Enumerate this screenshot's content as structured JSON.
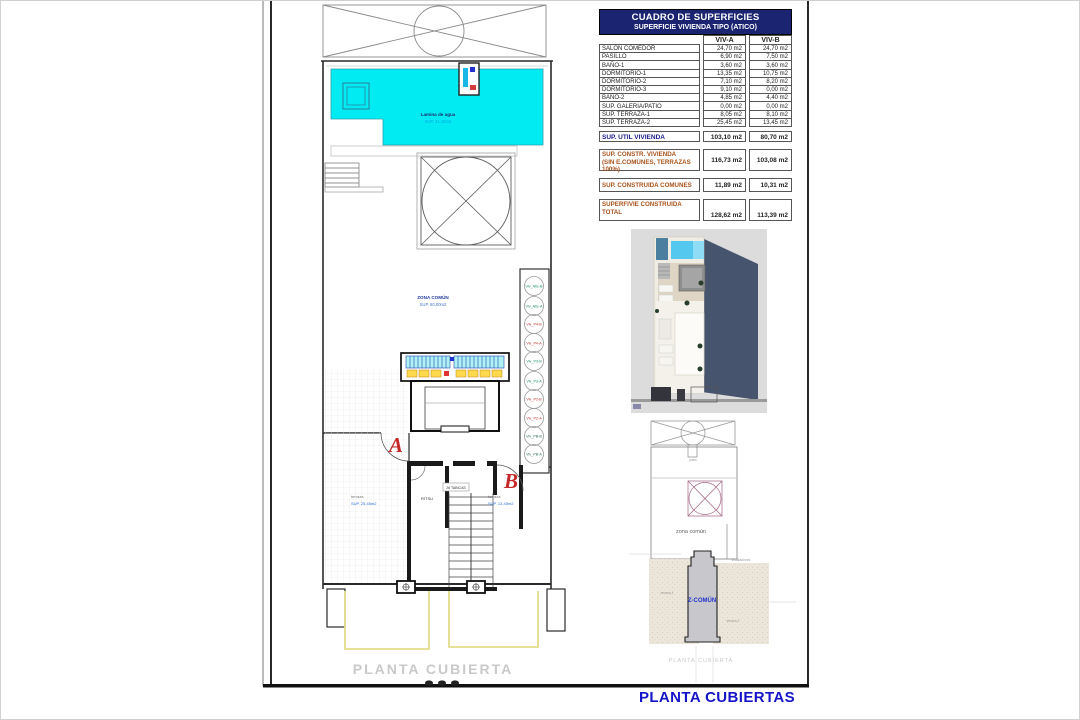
{
  "sheet": {
    "title": "PLANTA CUBIERTAS"
  },
  "colors": {
    "header_navy": "#1b2470",
    "total_navy": "#1a1a8c",
    "section_brown": "#a8521a",
    "sheet_blue": "#1414c8",
    "pool_cyan": "#00ecf2",
    "marker_red": "#c62828"
  },
  "surface_table": {
    "title": "CUADRO DE SUPERFICIES",
    "subtitle": "SUPERFICIE VIVIENDA TIPO  (ATICO)",
    "col_a": "VIV-A",
    "col_b": "VIV-B",
    "rows": [
      {
        "label": "SALON COMEDOR",
        "a": "24,70 m2",
        "b": "24,70 m2"
      },
      {
        "label": "PASILLO",
        "a": "6,90 m2",
        "b": "7,50 m2"
      },
      {
        "label": "BAÑO-1",
        "a": "3,60 m2",
        "b": "3,60 m2"
      },
      {
        "label": "DORMITORIO-1",
        "a": "13,35 m2",
        "b": "10,75 m2"
      },
      {
        "label": "DORMITORIO-2",
        "a": "7,10 m2",
        "b": "8,20 m2"
      },
      {
        "label": "DORMITORIO-3",
        "a": "9,10 m2",
        "b": "0,00 m2"
      },
      {
        "label": "BAÑO-2",
        "a": "4,85 m2",
        "b": "4,40 m2"
      },
      {
        "label": "SUP. GALERIA/PATIO",
        "a": "0,00 m2",
        "b": "0,00 m2"
      },
      {
        "label": "SUP. TERRAZA-1",
        "a": "8,05 m2",
        "b": "8,10 m2"
      },
      {
        "label": "SUP. TERRAZA-2",
        "a": "25,45 m2",
        "b": "13,45 m2"
      }
    ],
    "util": {
      "label": "SUP. UTIL VIVIENDA",
      "a": "103,10 m2",
      "b": "80,70 m2"
    },
    "constr": {
      "label1": "SUP. CONSTR. VIVIENDA",
      "label2": "(sin E.Comunes, terrazas 100%)",
      "a": "116,73 m2",
      "b": "103,08 m2"
    },
    "comunes": {
      "label": "SUP. CONSTRUIDA COMUNES",
      "a": "11,89 m2",
      "b": "10,31 m2"
    },
    "total": {
      "label1": "SUPERFIVIE CONSTRUIDA",
      "label2": "TOTAL",
      "a": "128,62 m2",
      "b": "113,39 m2"
    }
  },
  "plan": {
    "pool_label": "Lamina de agua",
    "pool_area": "SUP. 31,15m2",
    "zona_comun_label": "ZONA COMÚN",
    "zona_comun_area": "SUP. 60,00m2",
    "ritsu_label": "RITSU",
    "tabicas_label": "26 TABICAS",
    "section_a": "A",
    "section_b": "B",
    "terraza_left_label": "terraza",
    "terraza_left_area": "SUP. 25,45m2",
    "terraza_right_label": "terraza",
    "terraza_right_area": "SUP. 13,45m2",
    "caption": "PLANTA CUBIERTA",
    "vents": [
      "Viv_Atic-B",
      "Viv_Atic-A",
      "Viv_P4-B",
      "Viv_P4-A",
      "Viv_P3-B",
      "Viv_P3-A",
      "Viv_P2-B",
      "Viv_P2-A",
      "Viv_PB-B",
      "Viv_PB-A"
    ]
  },
  "key_plan": {
    "patio_label": "patio",
    "zona_comun": "zona común",
    "z_comun": "Z-COMÚN",
    "terraza_1": "terraza-1",
    "terraza_2": "terraza-2",
    "instalaciones": "instalaciones",
    "caption": "PLANTA CUBIERTA"
  }
}
